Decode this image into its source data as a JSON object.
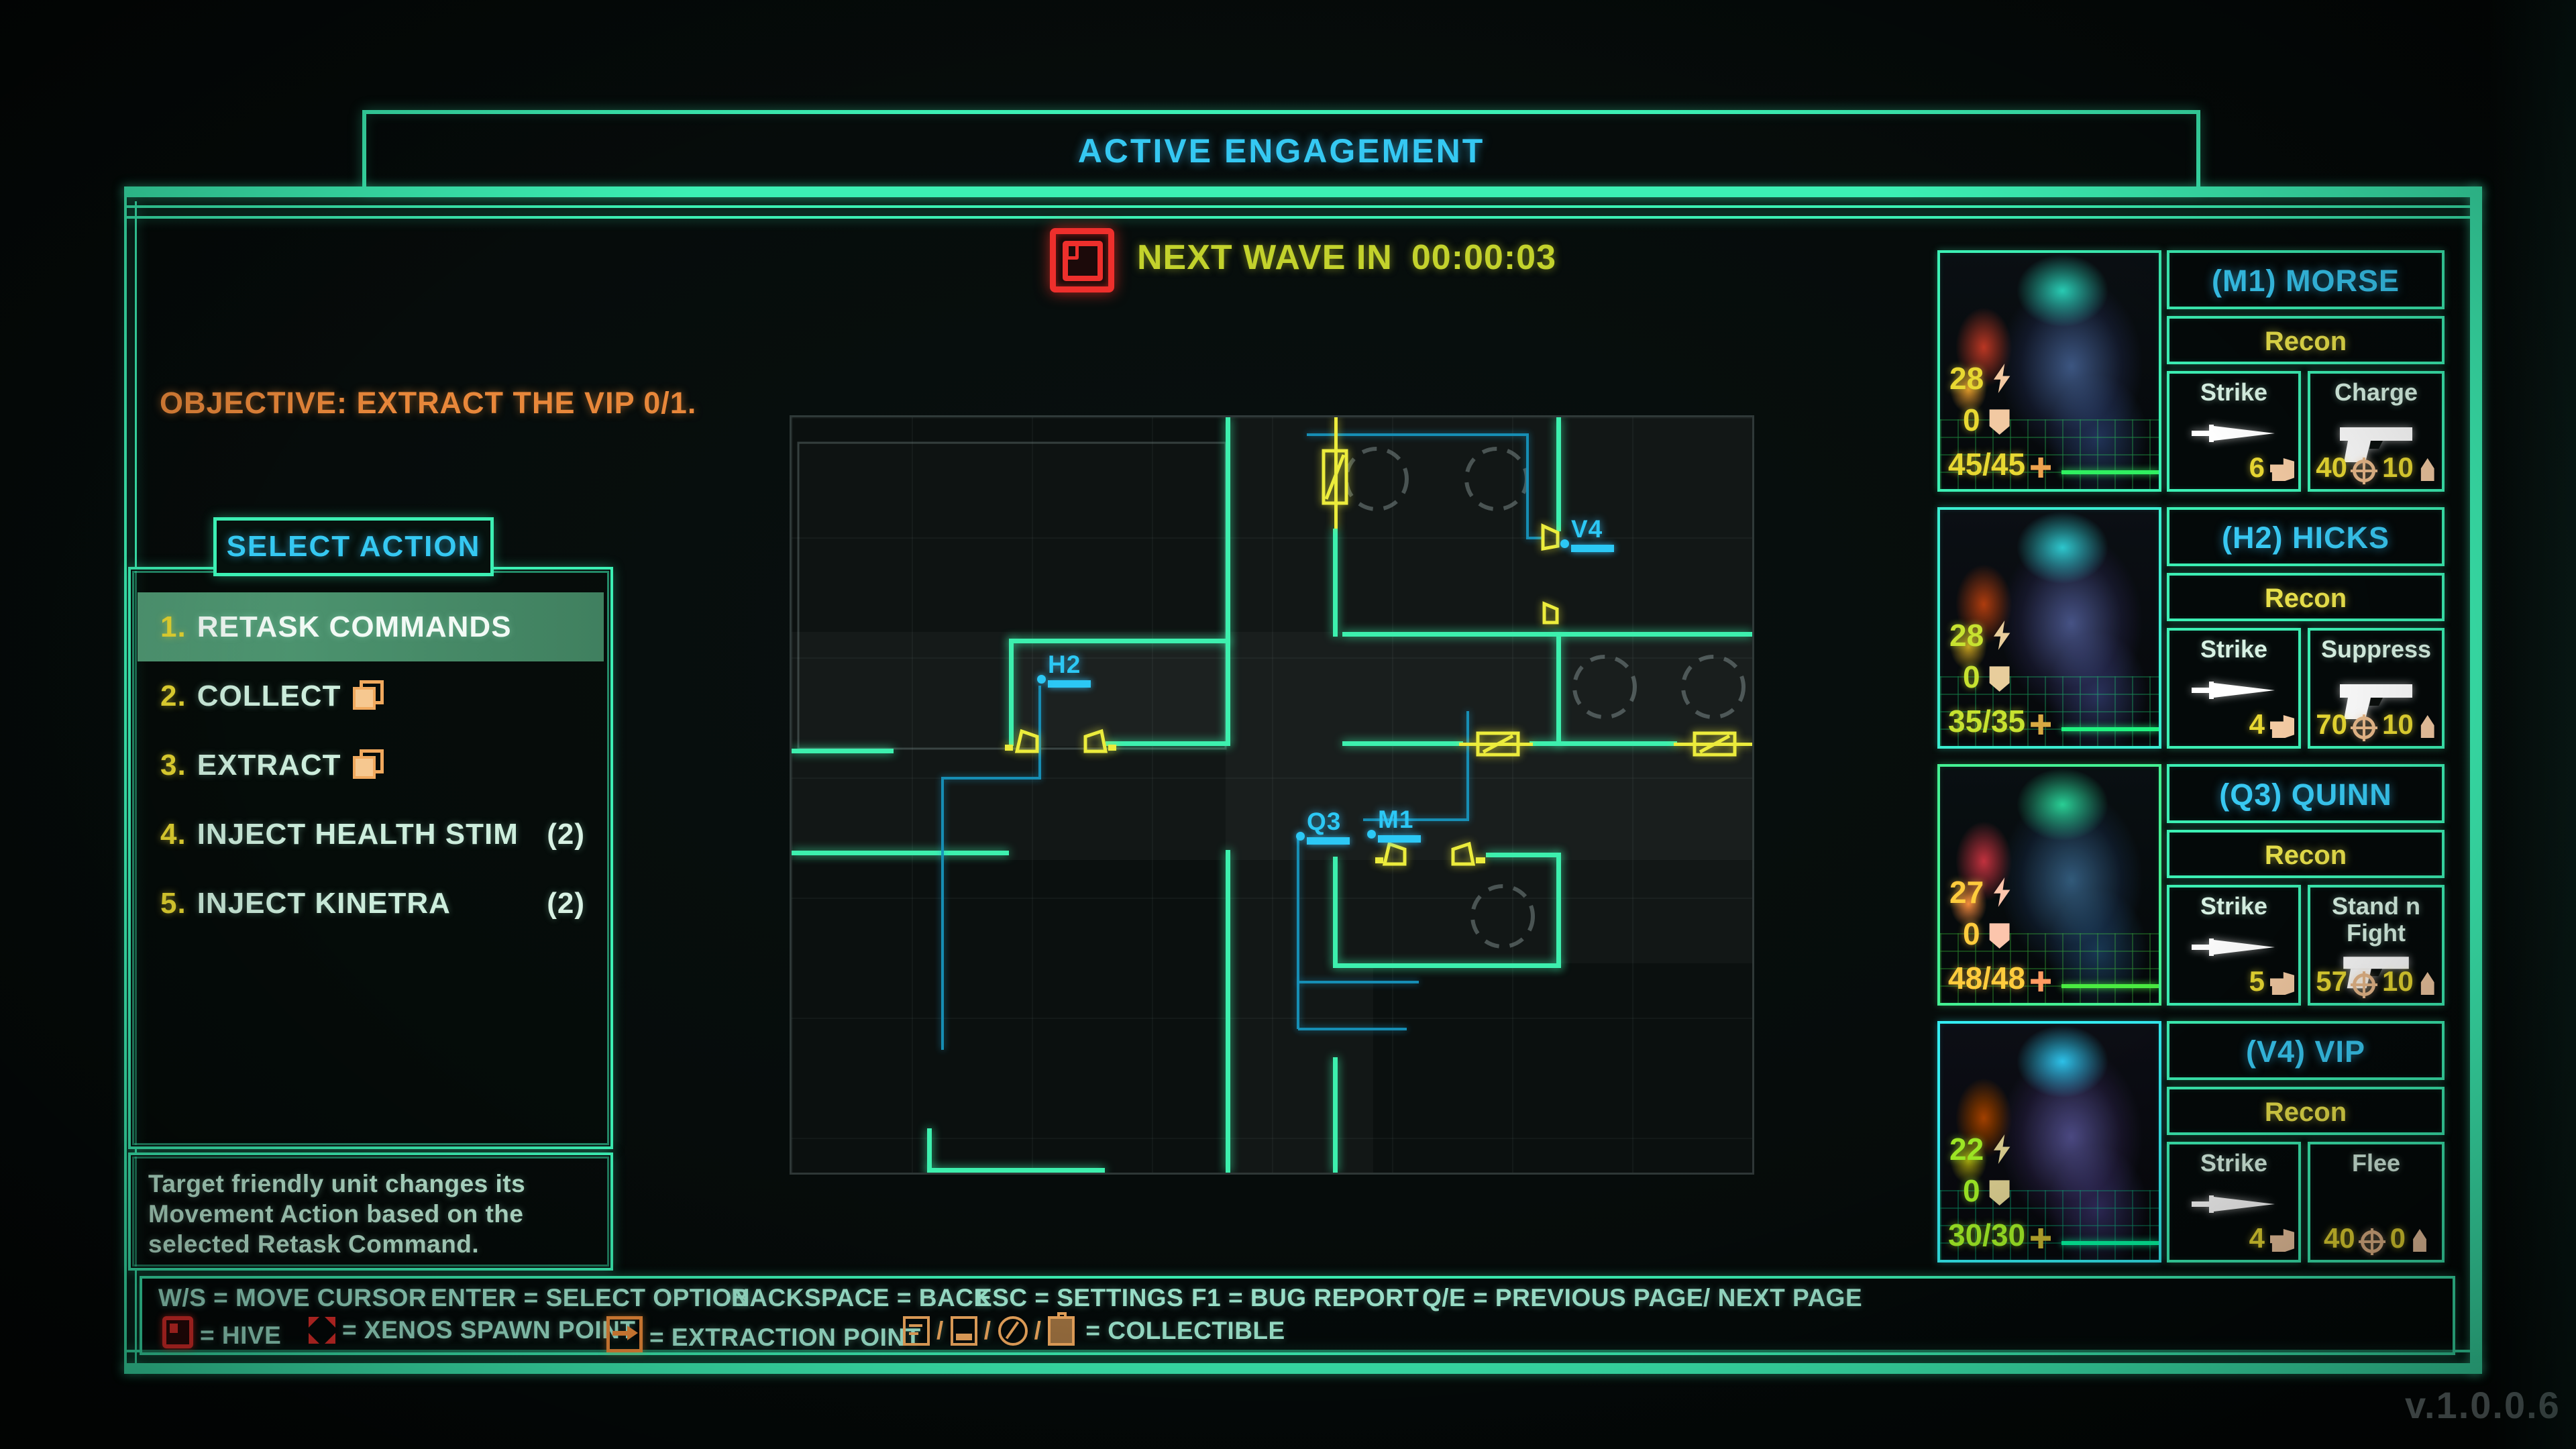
{
  "banner": {
    "title": "ACTIVE ENGAGEMENT"
  },
  "alert": {
    "label": "NEXT WAVE IN",
    "time": "00:00:03"
  },
  "objective": "OBJECTIVE: EXTRACT THE VIP 0/1.",
  "action_menu": {
    "title": "SELECT ACTION",
    "items": [
      {
        "num": "1.",
        "label": "RETASK COMMANDS",
        "count": ""
      },
      {
        "num": "2.",
        "label": "COLLECT",
        "count": ""
      },
      {
        "num": "3.",
        "label": "EXTRACT",
        "count": ""
      },
      {
        "num": "4.",
        "label": "INJECT HEALTH STIM",
        "count": "(2)"
      },
      {
        "num": "5.",
        "label": "INJECT KINETRA",
        "count": "(2)"
      }
    ]
  },
  "description": {
    "line1": "Target friendly unit changes its",
    "line2": "Movement Action based on the",
    "line3": "selected Retask Command."
  },
  "controls": {
    "row1": [
      "W/S = MOVE CURSOR",
      "ENTER = SELECT OPTION",
      "BACKSPACE = BACK",
      "ESC = SETTINGS",
      "F1 = BUG REPORT",
      "Q/E = PREVIOUS PAGE/ NEXT PAGE"
    ],
    "hive": "= HIVE",
    "xenos": "= XENOS SPAWN POINT",
    "extraction": "= EXTRACTION POINT",
    "collectible": "= COLLECTIBLE",
    "slash": "/"
  },
  "map": {
    "units": [
      {
        "id": "H2"
      },
      {
        "id": "V4"
      },
      {
        "id": "Q3"
      },
      {
        "id": "M1"
      }
    ]
  },
  "squad": [
    {
      "name": "(M1) MORSE",
      "unit_class": "Recon",
      "move": "28",
      "armor": "0",
      "hp": "45/45",
      "ability1": {
        "name": "Strike",
        "value": "6"
      },
      "ability2": {
        "name": "Charge",
        "acc": "40",
        "ammo": "10"
      }
    },
    {
      "name": "(H2) HICKS",
      "unit_class": "Recon",
      "move": "28",
      "armor": "0",
      "hp": "35/35",
      "ability1": {
        "name": "Strike",
        "value": "4"
      },
      "ability2": {
        "name": "Suppress",
        "acc": "70",
        "ammo": "10"
      }
    },
    {
      "name": "(Q3) QUINN",
      "unit_class": "Recon",
      "move": "27",
      "armor": "0",
      "hp": "48/48",
      "ability1": {
        "name": "Strike",
        "value": "5"
      },
      "ability2": {
        "name": "Stand n Fight",
        "acc": "57",
        "ammo": "10"
      }
    },
    {
      "name": "(V4) VIP",
      "unit_class": "Recon",
      "move": "22",
      "armor": "0",
      "hp": "30/30",
      "ability1": {
        "name": "Strike",
        "value": "4"
      },
      "ability2": {
        "name": "Flee",
        "acc": "40",
        "ammo": "0"
      }
    }
  ],
  "version": "v.1.0.0.6",
  "colors": {
    "teal": "#3cf0b4",
    "cyan": "#35c8f2",
    "yellow": "#e8d832",
    "orange": "#ef8c3a",
    "red": "#ee2f2c",
    "mint": "#cdeedd"
  }
}
